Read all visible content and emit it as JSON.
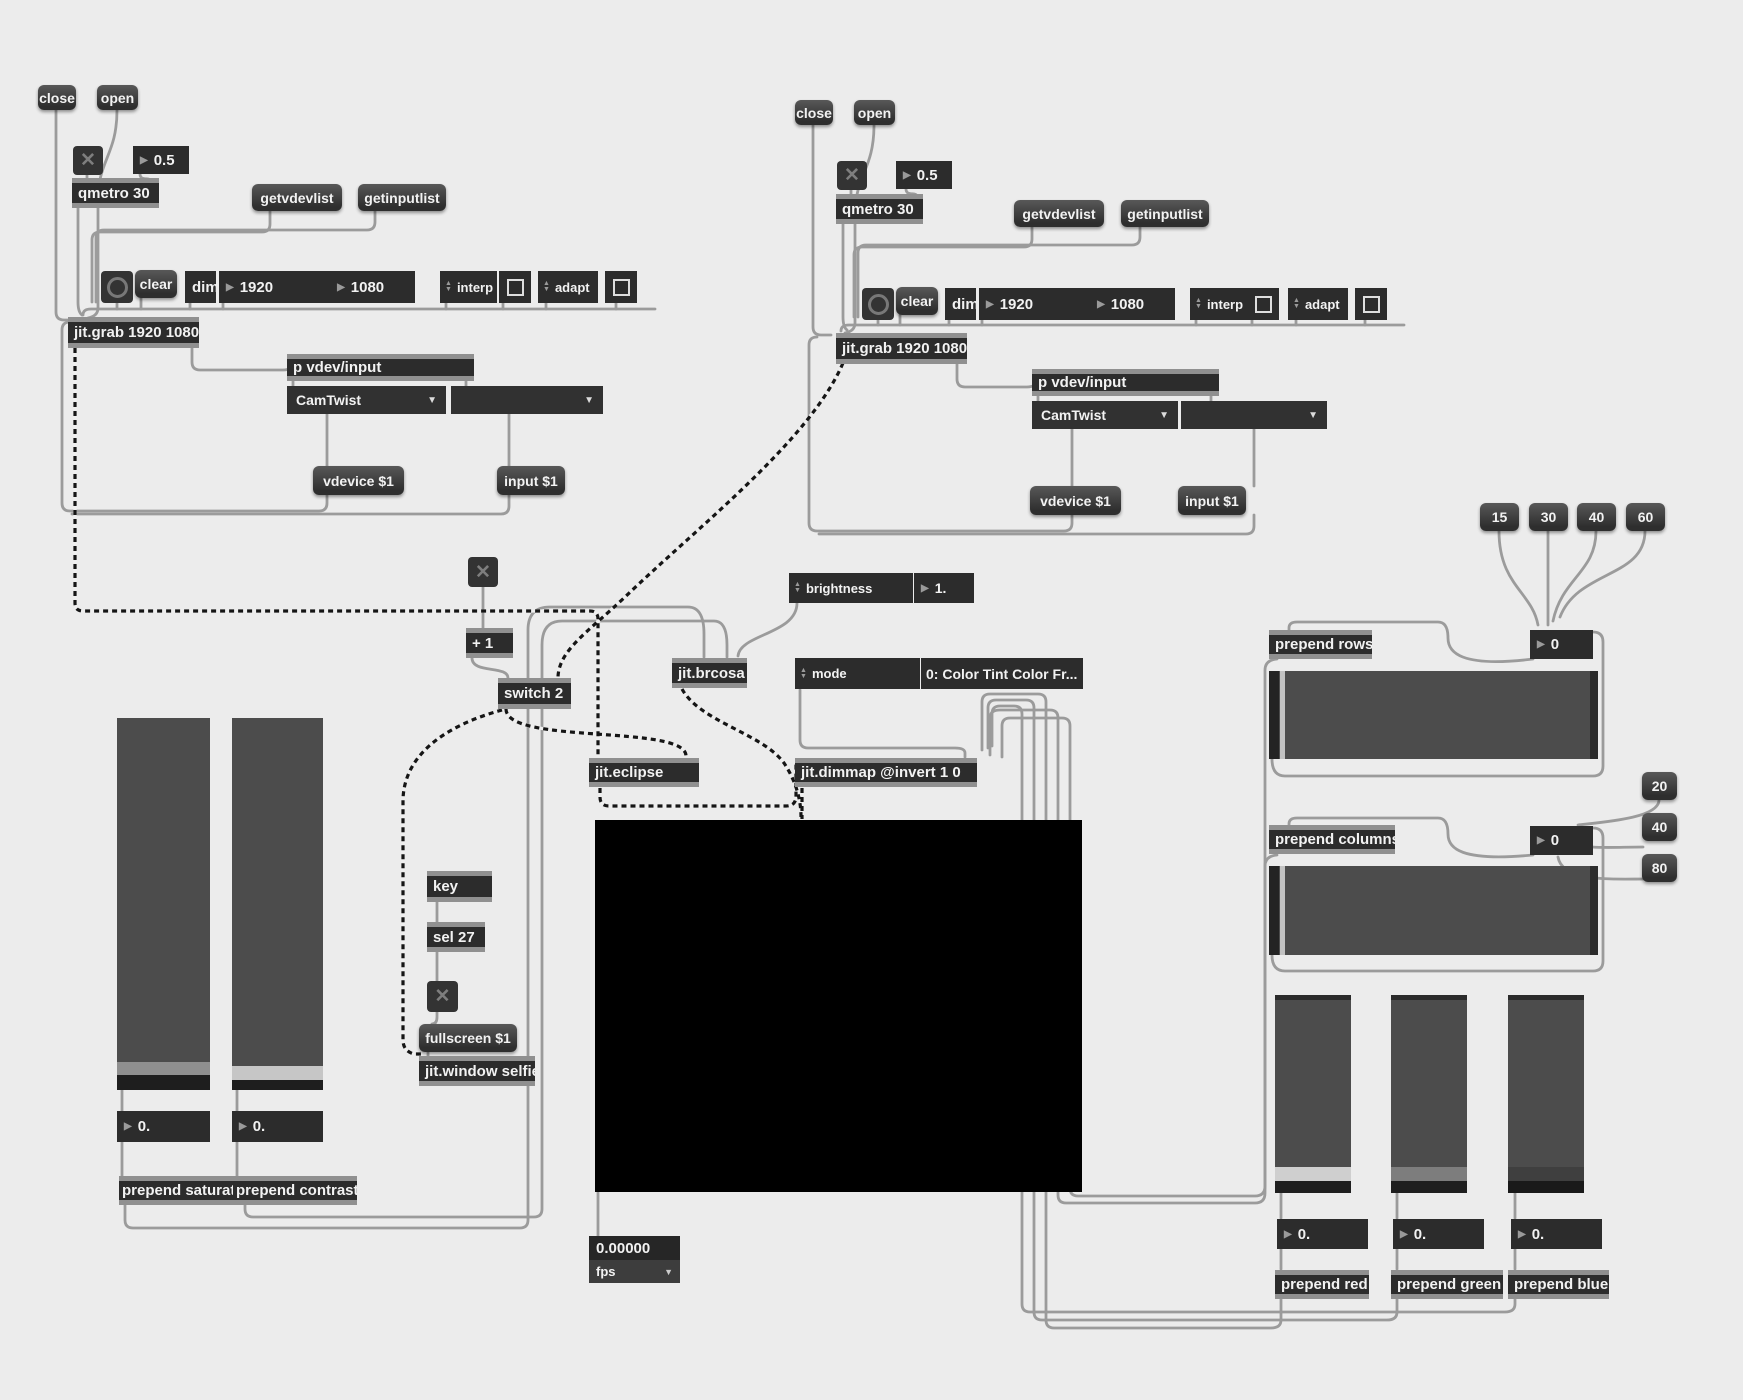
{
  "colors": {
    "background": "#ececec",
    "box": "#2c2c2c",
    "strip": "#909090",
    "cord": "#9b9b9b",
    "window": "#000000"
  },
  "glyphs": {
    "toggle_x": "✕",
    "menu_arrow": "▼",
    "num_arrow": "▶",
    "spin_up": "▲",
    "spin_down": "▼"
  },
  "grabber_left": {
    "close": "close",
    "open": "open",
    "rate": "0.5",
    "qmetro": "qmetro 30",
    "getvdevlist": "getvdevlist",
    "getinputlist": "getinputlist",
    "clear": "clear",
    "dim": "dim",
    "width": "1920",
    "height": "1080",
    "interp": "interp",
    "adapt": "adapt",
    "grab": "jit.grab 1920 1080",
    "subpatch": "p vdev/input",
    "device_menu": "CamTwist",
    "input_menu": "",
    "vdevice_msg": "vdevice $1",
    "input_msg": "input $1"
  },
  "grabber_right": {
    "close": "close",
    "open": "open",
    "rate": "0.5",
    "qmetro": "qmetro 30",
    "getvdevlist": "getvdevlist",
    "getinputlist": "getinputlist",
    "clear": "clear",
    "dim": "dim",
    "width": "1920",
    "height": "1080",
    "interp": "interp",
    "adapt": "adapt",
    "grab": "jit.grab 1920 1080",
    "subpatch": "p vdev/input",
    "device_menu": "CamTwist",
    "input_menu": "",
    "vdevice_msg": "vdevice $1",
    "input_msg": "input $1"
  },
  "processing": {
    "plus_one": "+ 1",
    "switch": "switch 2",
    "brcosa": "jit.brcosa",
    "brightness_label": "brightness",
    "brightness_value": "1.",
    "mode_label": "mode",
    "mode_value": "0: Color Tint Color Fr...",
    "eclipse": "jit.eclipse",
    "dimmap": "jit.dimmap @invert 1 0"
  },
  "keyboard": {
    "key": "key",
    "sel": "sel 27",
    "fullscreen": "fullscreen $1",
    "window": "jit.window selfie"
  },
  "fps": {
    "value": "0.00000",
    "label": "fps"
  },
  "saturation_contrast": {
    "sat_value": "0.",
    "con_value": "0.",
    "prepend_saturation": "prepend saturation",
    "prepend_contrast": "prepend contrast"
  },
  "rows": {
    "presets": [
      "15",
      "30",
      "40",
      "60"
    ],
    "prepend": "prepend rows",
    "value": "0"
  },
  "columns": {
    "presets": [
      "20",
      "40",
      "80"
    ],
    "prepend": "prepend columns",
    "value": "0"
  },
  "rgb": {
    "red_value": "0.",
    "green_value": "0.",
    "blue_value": "0.",
    "prepend_red": "prepend red",
    "prepend_green": "prepend green",
    "prepend_blue": "prepend blue"
  }
}
